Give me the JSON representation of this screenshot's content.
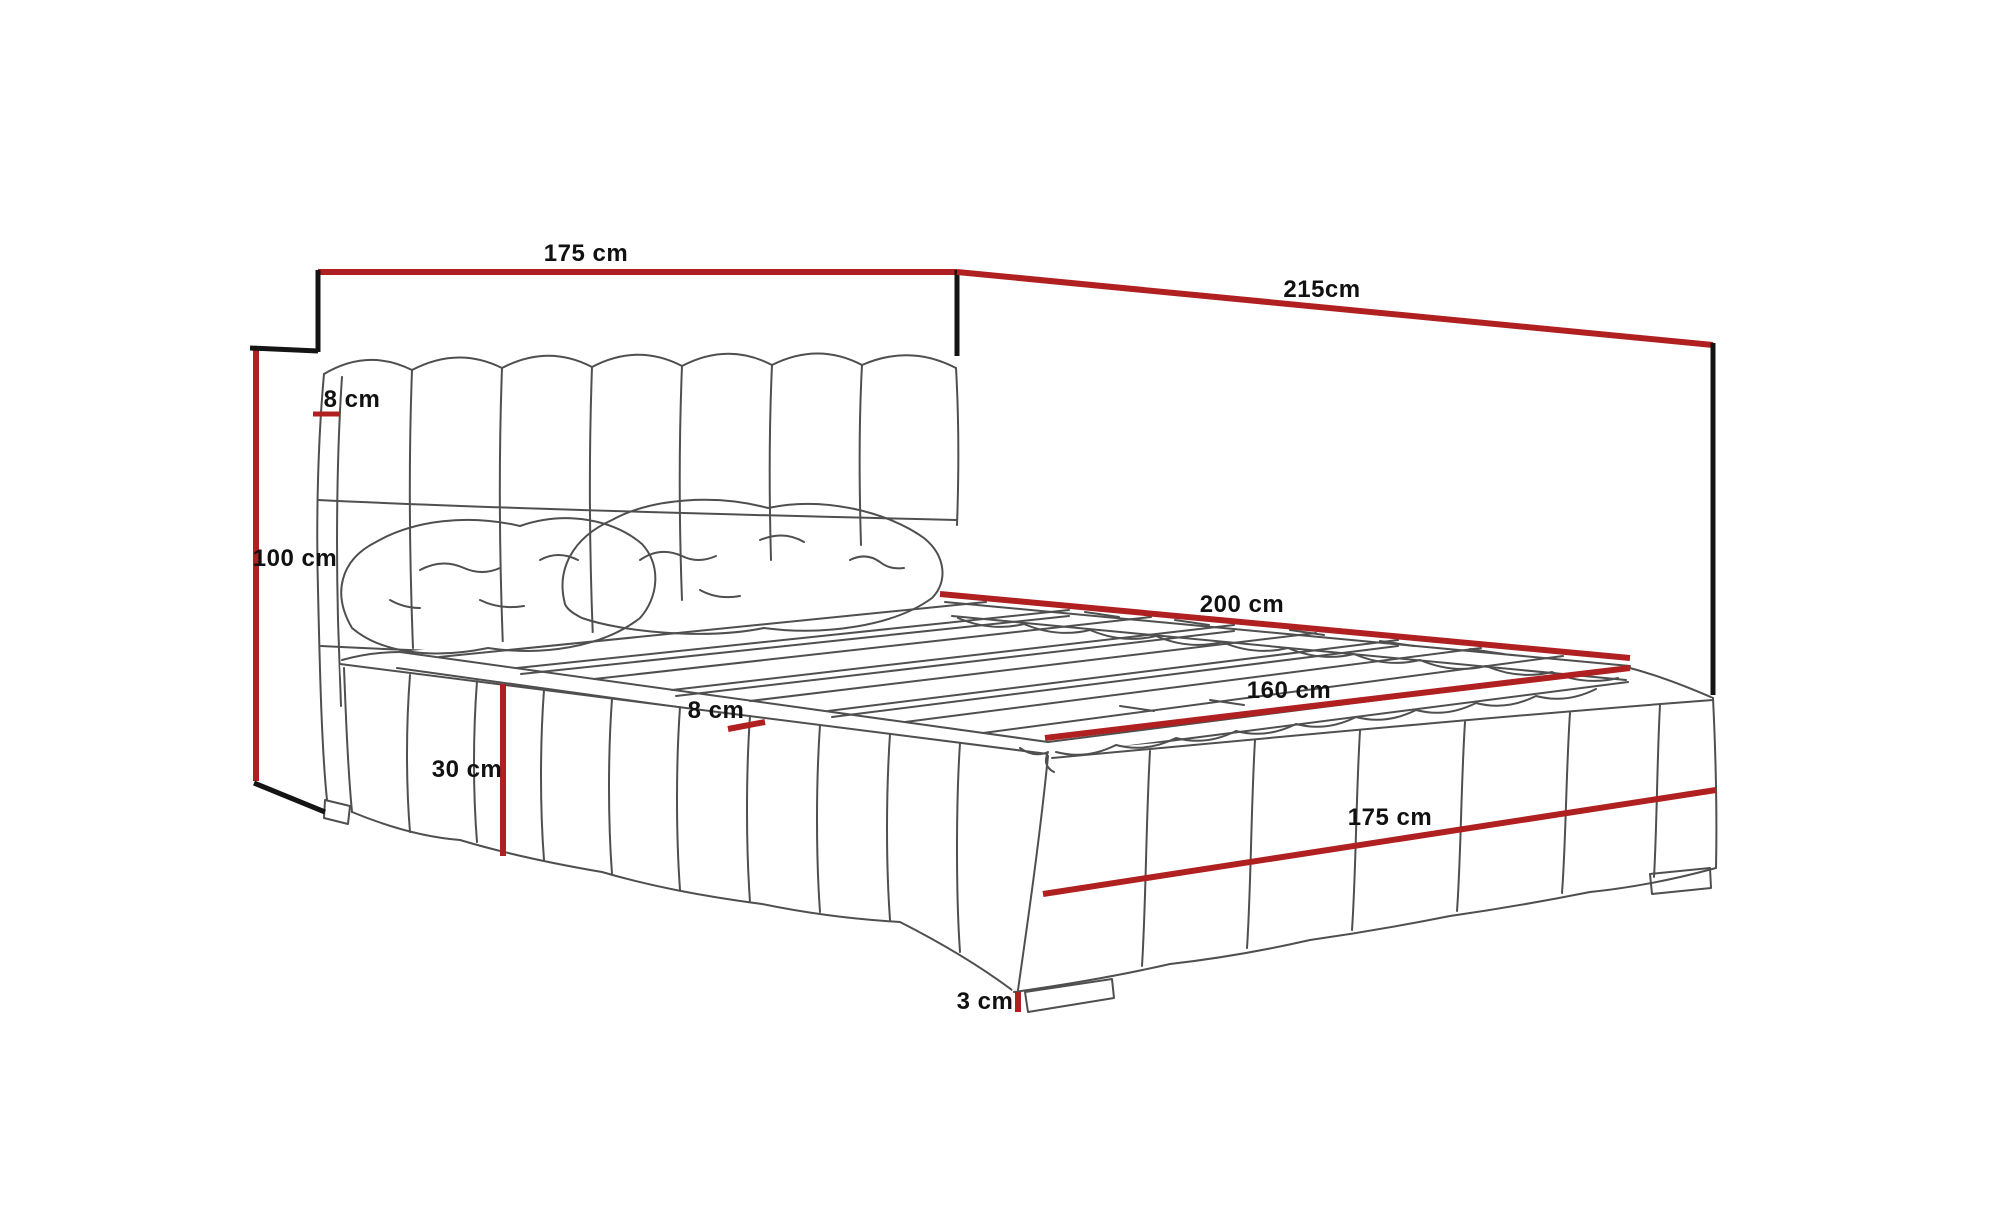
{
  "figure": {
    "type": "furniture-dimension-diagram",
    "subject": "Upholstered bed with tufted headboard, slatted platform and upholstered base, annotated with dimension lines"
  },
  "colors": {
    "background": "#ffffff",
    "dimension_line_red": "#b02020",
    "bracket_line_black": "#141414",
    "sketch_line_gray": "#4f4f4f",
    "label_text": "#111111"
  },
  "dimensions": {
    "headboard_width": "175 cm",
    "overall_length": "215cm",
    "headboard_height": "100 cm",
    "headboard_thickness": "8 cm",
    "mattress_length": "200 cm",
    "mattress_width": "160 cm",
    "base_height": "30 cm",
    "platform_edge": "8 cm",
    "base_width": "175 cm",
    "foot_height": "3 cm"
  }
}
